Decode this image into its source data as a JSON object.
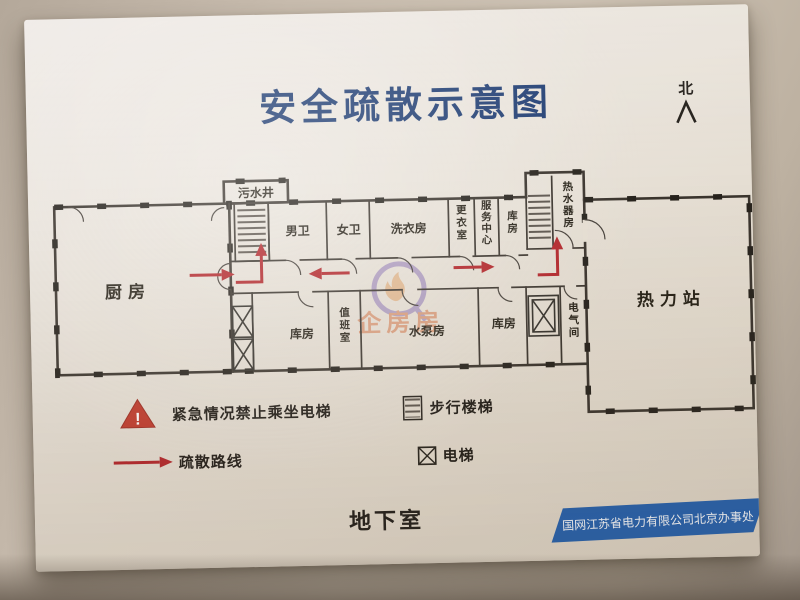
{
  "title": "安全疏散示意图",
  "compass": {
    "label": "北"
  },
  "rooms": {
    "wushuijing": "污水井",
    "nanwei": "男卫",
    "nvwei": "女卫",
    "xiyifang": "洗衣房",
    "gengyishi": "更衣室",
    "fuwu_zhongxin": "服务中心",
    "kufang_top": "库房",
    "reshuiqifang": "热水器房",
    "chufang": "厨房",
    "relizhan": "热力站",
    "kufang_left": "库房",
    "zhibanshi": "值班室",
    "shuibengfang": "水泵房",
    "kufang_right": "库房",
    "dianqijian": "电气间"
  },
  "legend": {
    "warning_mark": "!",
    "no_elevator": "紧急情况禁止乘坐电梯",
    "route": "疏散路线",
    "stairs": "步行楼梯",
    "elevator": "电梯"
  },
  "footer": {
    "floor": "地下室",
    "company": "国网江苏省电力有限公司北京办事处"
  },
  "watermark": {
    "text": "企房房"
  },
  "colors": {
    "title_blue": "#1c3a70",
    "banner_blue": "#1f5cab",
    "arrow_red": "#b3252a",
    "wall_dark": "#3a342d"
  }
}
